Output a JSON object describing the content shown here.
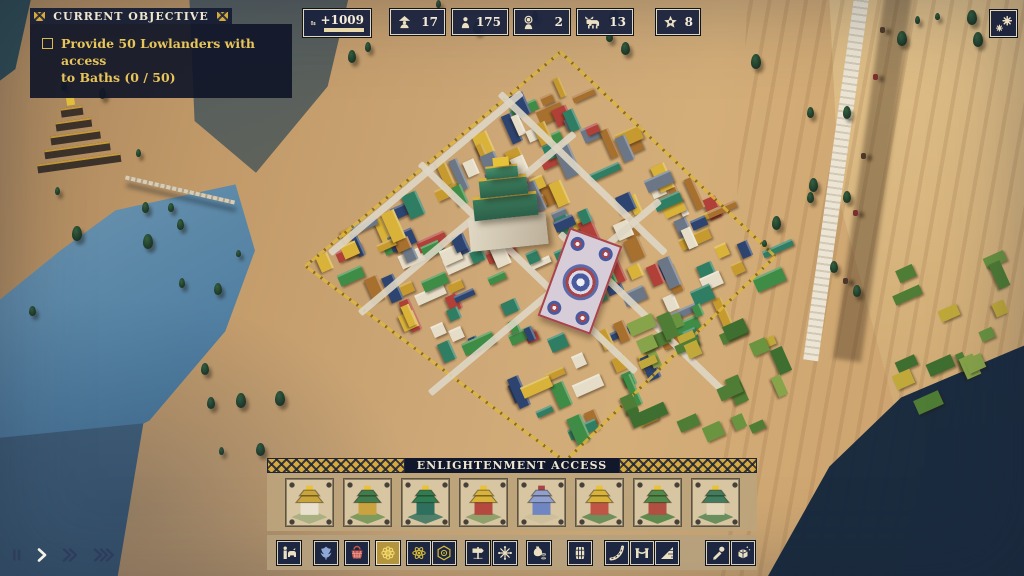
{
  "objective": {
    "header": "CURRENT OBJECTIVE",
    "line1": "Provide 50 Lowlanders with access",
    "line2": "to Baths (0 / 50)"
  },
  "resources": {
    "money": {
      "icon": "coins-icon",
      "value": "+1009"
    },
    "items": [
      {
        "icon": "lowlander-icon",
        "value": "17"
      },
      {
        "icon": "worker-icon",
        "value": "175"
      },
      {
        "icon": "monk-icon",
        "value": "2"
      },
      {
        "icon": "yak-icon",
        "value": "13"
      },
      {
        "icon": "prestige-star-icon",
        "value": "8"
      }
    ]
  },
  "weather_button": {
    "icon": "snowflakes-icon"
  },
  "build_panel": {
    "header": "ENLIGHTENMENT ACCESS",
    "buildings": [
      {
        "vars": "--roof:#c9a43a;--wall:#e9e1cd;--base:#a9b183;--accent:#e8c23a"
      },
      {
        "vars": "--roof:#3f7d4e;--wall:#caa23f;--base:#7e9a5e;--accent:#e8c23a"
      },
      {
        "vars": "--roof:#2e7d52;--wall:#2f6f5e;--base:#4f7f68;--accent:#e8c23a"
      },
      {
        "vars": "--roof:#d9b23a;--wall:#b5483f;--base:#8fa06a;--accent:#e8c23a"
      },
      {
        "vars": "--roof:#8f9fd0;--wall:#6f86c2;--base:#cdbf9a;--accent:#a84448"
      },
      {
        "vars": "--roof:#d9b23a;--wall:#c05545;--base:#6f8f5a;--accent:#e8c23a"
      },
      {
        "vars": "--roof:#4f8a4a;--wall:#b04f42;--base:#5e8a4f;--accent:#e8c23a"
      },
      {
        "vars": "--roof:#3f7d5e;--wall:#e2d5b8;--base:#6a8f5f;--accent:#e8c23a"
      }
    ]
  },
  "toolbar": {
    "buttons": [
      {
        "icon": "yak-caravan-icon",
        "selected": false
      },
      {
        "icon": "herbs-icon",
        "selected": false
      },
      {
        "icon": "basket-icon",
        "selected": false
      },
      {
        "icon": "mandala-icon",
        "selected": true
      },
      {
        "icon": "incense-icon",
        "selected": false
      },
      {
        "icon": "honeycomb-icon",
        "selected": false
      },
      {
        "icon": "signpost-icon",
        "selected": false
      },
      {
        "icon": "blossom-icon",
        "selected": false
      },
      {
        "icon": "money-bag-icon",
        "selected": false
      },
      {
        "icon": "barrel-icon",
        "selected": false
      },
      {
        "icon": "road-icon",
        "selected": false
      },
      {
        "icon": "bridge-icon",
        "selected": false
      },
      {
        "icon": "ramp-icon",
        "selected": false
      },
      {
        "icon": "eyedropper-icon",
        "selected": false
      },
      {
        "icon": "demolish-icon",
        "selected": false
      }
    ]
  },
  "time_controls": {
    "options": [
      "pause",
      "play",
      "fast-forward",
      "fastest"
    ],
    "active": "play"
  },
  "colors": {
    "panel_navy": "#1b2440",
    "panel_border": "#e6d8b4",
    "gold_text": "#e8c55a",
    "cream_text": "#efe6d0",
    "ornament_gold": "#d7a93c",
    "strip_tan": "#bca47c",
    "selected_gold": "#b3953f",
    "icon_cream": "#ece0c2"
  },
  "scene": {
    "terrain": "#c9a272",
    "lake": "#4a7a9e",
    "road": "#ece5d5",
    "shadow": "#14273d",
    "tree": "#24402c",
    "wall_gold": "#dcb63e",
    "city_palette": [
      "#d9b23a",
      "#c69a2e",
      "#2f7d62",
      "#3f8c46",
      "#b04038",
      "#2d4470",
      "#6b7787",
      "#e6ddc8",
      "#a8702e"
    ],
    "field_palette": [
      "#4f7d35",
      "#6a9440",
      "#87a44a",
      "#c0a93a",
      "#3f6f30"
    ]
  }
}
